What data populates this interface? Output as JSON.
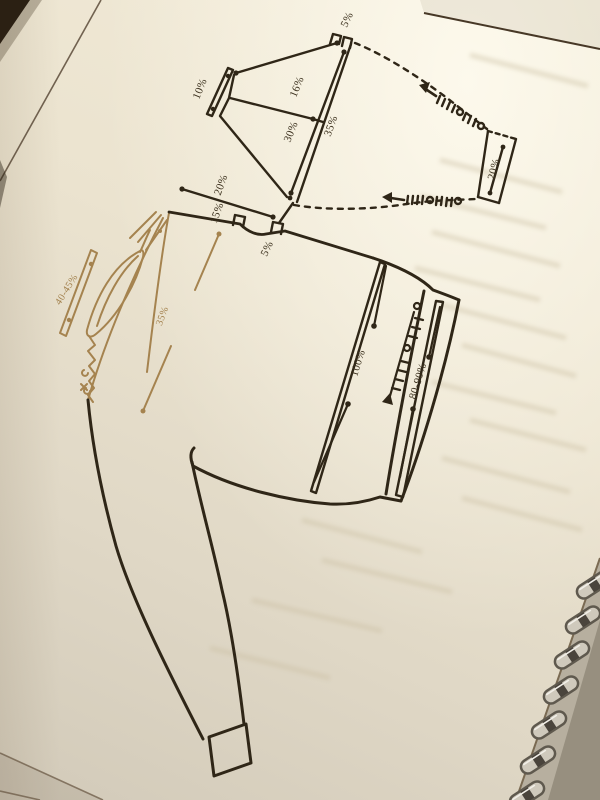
{
  "labels": {
    "sleeve_cap_top": "5%",
    "sleeve_cap_left": "10%",
    "sleeve_cap_upper": "16%",
    "sleeve_cap_lower": "30%",
    "sleeve_cap_edge": "35%",
    "collar_stand": "20%",
    "neck_width": "20%",
    "shoulder": "15%",
    "neck_drop": "5%",
    "armhole_depth": "35%",
    "collar": "40-45%",
    "body_length": "100%",
    "front_band": "80-90%"
  },
  "colors": {
    "ink": "#2f2617",
    "faded_ink": "#a5834f",
    "paper": "#e9e1ce",
    "shadow": "#241a10",
    "metal": "#cfc9bc"
  }
}
